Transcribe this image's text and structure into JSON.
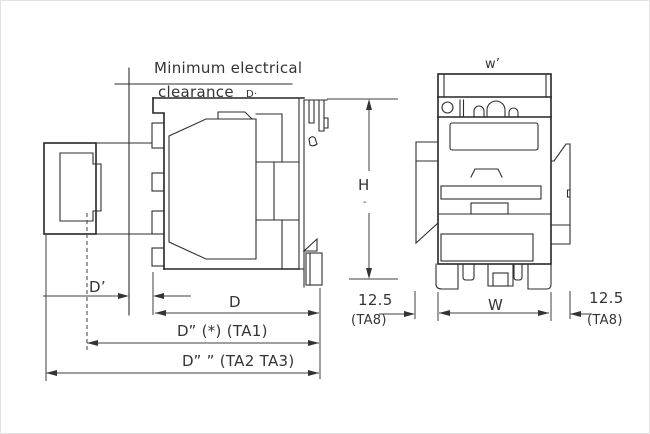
{
  "note": {
    "line1": "Minimum electrical",
    "line2": "clearance",
    "suffix": "D·"
  },
  "side_view_dims": {
    "d_prime": "D’",
    "d": "D",
    "d_ta1": "D” (*) (TA1)",
    "d_ta2": "D” ” (TA2 TA3)",
    "h": "H",
    "h_tick": "-"
  },
  "front_view_dims": {
    "w_top": "w’",
    "w": "W",
    "left_offset_value": "12.5",
    "left_offset_ref": "(TA8)",
    "right_offset_value": "12.5",
    "right_offset_ref": "(TA8)"
  },
  "colors": {
    "line": "#262626",
    "dimension_line": "#3f3f3f",
    "text": "#343434",
    "background": "#ffffff"
  }
}
